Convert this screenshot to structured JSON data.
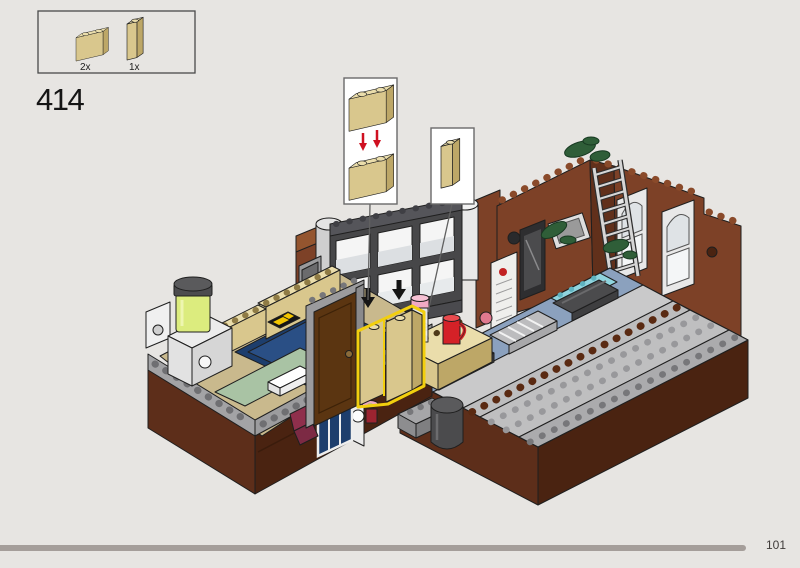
{
  "page": {
    "number": "101",
    "background_color": "#e7e5e2"
  },
  "progress_bar": {
    "fraction": 0.93,
    "color": "#a59e9a"
  },
  "step": {
    "number": "414"
  },
  "parts_panel": {
    "parts": [
      {
        "icon": "brick-1x2-tan-icon",
        "count": "2x",
        "color": "#d9c78d"
      },
      {
        "icon": "brick-1x1-tall-tan-icon",
        "count": "1x",
        "color": "#d9c78d"
      }
    ]
  },
  "callouts": {
    "stack": {
      "icon": "two-tan-bricks-stack-icon",
      "arrow_color": "#cf1021"
    },
    "single": {
      "icon": "brick-1x1-tall-tan-icon"
    }
  },
  "model": {
    "menu_sign_text": "MENU",
    "highlight_color": "#f2cf0e",
    "palette": {
      "tan": "#d9c78d",
      "brick_brown": "#7d4127",
      "base_brown": "#5d2e1a",
      "sand_blue": "#8ba1be",
      "couch_navy": "#1d3e6d",
      "vine_green": "#2f5e38"
    }
  }
}
